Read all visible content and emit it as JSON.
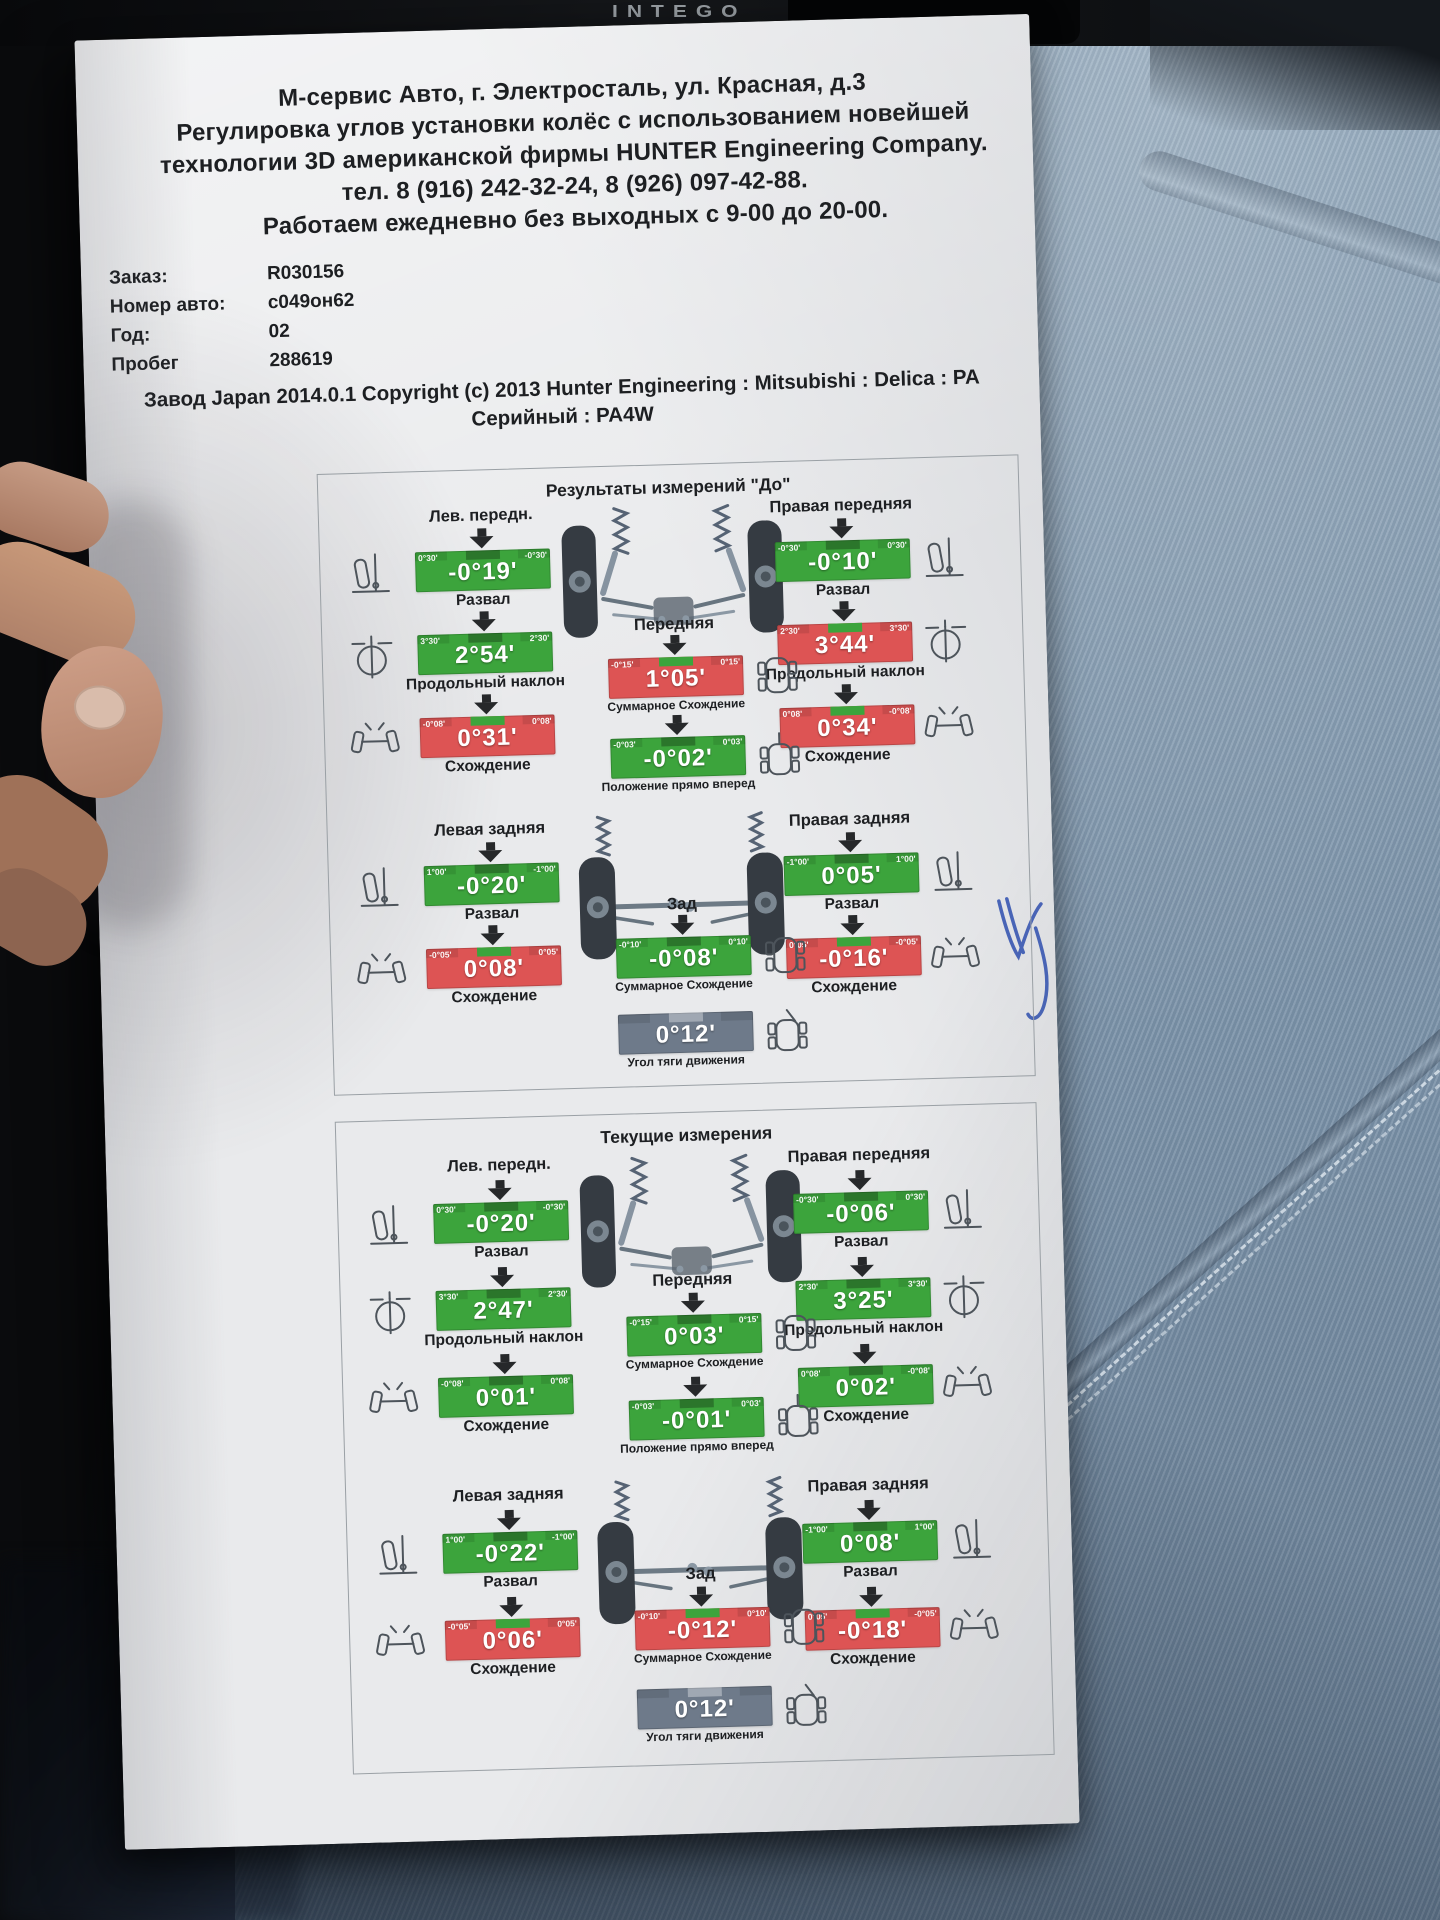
{
  "scene": {
    "dashboard_text": "INTEGO"
  },
  "header": {
    "lines": [
      "М-сервис Авто, г. Электросталь, ул. Красная, д.3",
      "Регулировка углов установки колёс с использованием новейшей",
      "технологии 3D американской фирмы HUNTER Engineering Company.",
      "тел. 8 (916) 242-32-24, 8 (926) 097-42-88.",
      "Работаем ежедневно без выходных с 9-00 до 20-00."
    ]
  },
  "info": {
    "rows": [
      {
        "label": "Заказ:",
        "value": "R030156"
      },
      {
        "label": "Номер авто:",
        "value": "с049он62"
      },
      {
        "label": "Год:",
        "value": "02"
      },
      {
        "label": "Пробег",
        "value": "288619"
      }
    ]
  },
  "factory": {
    "line1": "Завод Japan 2014.0.1 Copyright (c) 2013 Hunter Engineering : Mitsubishi : Delica : PA",
    "line2": "Серийный : PA4W"
  },
  "colors": {
    "green": "#3ca43c",
    "red": "#dd5454",
    "gray": "#6e7a8a"
  },
  "annotation": {
    "shape": "pen-checkmark",
    "color": "#2e4faf"
  },
  "panels": [
    {
      "title": "Результаты измерений \"До\"",
      "front": {
        "left_label": "Лев. передн.",
        "right_label": "Правая передняя",
        "axle_label": "Передняя",
        "left": [
          {
            "caption": "Развал",
            "value": "-0°19'",
            "status": "green",
            "range_left": "0°30'",
            "range_right": "-0°30'",
            "icon": "camber-icon"
          },
          {
            "caption": "Продольный наклон",
            "value": "2°54'",
            "status": "green",
            "range_left": "3°30'",
            "range_right": "2°30'",
            "icon": "caster-icon"
          },
          {
            "caption": "Схождение",
            "value": "0°31'",
            "status": "red",
            "range_left": "-0°08'",
            "range_right": "0°08'",
            "icon": "toe-icon"
          }
        ],
        "right": [
          {
            "caption": "Развал",
            "value": "-0°10'",
            "status": "green",
            "range_left": "-0°30'",
            "range_right": "0°30'",
            "icon": "camber-icon"
          },
          {
            "caption": "Продольный наклон",
            "value": "3°44'",
            "status": "red",
            "range_left": "2°30'",
            "range_right": "3°30'",
            "icon": "caster-icon"
          },
          {
            "caption": "Схождение",
            "value": "0°34'",
            "status": "red",
            "range_left": "0°08'",
            "range_right": "-0°08'",
            "icon": "toe-icon"
          }
        ],
        "center": [
          {
            "caption": "Суммарное Схождение",
            "value": "1°05'",
            "status": "red",
            "range_left": "-0°15'",
            "range_right": "0°15'",
            "icon": "total-toe-icon"
          },
          {
            "caption": "Положение прямо вперед",
            "value": "-0°02'",
            "status": "green",
            "range_left": "-0°03'",
            "range_right": "0°03'",
            "icon": "straight-ahead-icon"
          }
        ]
      },
      "rear": {
        "left_label": "Левая задняя",
        "right_label": "Правая задняя",
        "axle_label": "Зад",
        "left": [
          {
            "caption": "Развал",
            "value": "-0°20'",
            "status": "green",
            "range_left": "1°00'",
            "range_right": "-1°00'",
            "icon": "camber-icon"
          },
          {
            "caption": "Схождение",
            "value": "0°08'",
            "status": "red",
            "range_left": "-0°05'",
            "range_right": "0°05'",
            "icon": "toe-icon"
          }
        ],
        "right": [
          {
            "caption": "Развал",
            "value": "0°05'",
            "status": "green",
            "range_left": "-1°00'",
            "range_right": "1°00'",
            "icon": "camber-icon"
          },
          {
            "caption": "Схождение",
            "value": "-0°16'",
            "status": "red",
            "range_left": "0°05'",
            "range_right": "-0°05'",
            "icon": "toe-icon"
          }
        ],
        "center": [
          {
            "caption": "Суммарное Схождение",
            "value": "-0°08'",
            "status": "green",
            "range_left": "-0°10'",
            "range_right": "0°10'",
            "icon": "total-toe-icon"
          },
          {
            "caption": "Угол тяги движения",
            "value": "0°12'",
            "status": "gray",
            "range_left": "",
            "range_right": "",
            "icon": "thrust-icon"
          }
        ]
      }
    },
    {
      "title": "Текущие измерения",
      "front": {
        "left_label": "Лев. передн.",
        "right_label": "Правая передняя",
        "axle_label": "Передняя",
        "left": [
          {
            "caption": "Развал",
            "value": "-0°20'",
            "status": "green",
            "range_left": "0°30'",
            "range_right": "-0°30'",
            "icon": "camber-icon"
          },
          {
            "caption": "Продольный наклон",
            "value": "2°47'",
            "status": "green",
            "range_left": "3°30'",
            "range_right": "2°30'",
            "icon": "caster-icon"
          },
          {
            "caption": "Схождение",
            "value": "0°01'",
            "status": "green",
            "range_left": "-0°08'",
            "range_right": "0°08'",
            "icon": "toe-icon"
          }
        ],
        "right": [
          {
            "caption": "Развал",
            "value": "-0°06'",
            "status": "green",
            "range_left": "-0°30'",
            "range_right": "0°30'",
            "icon": "camber-icon"
          },
          {
            "caption": "Продольный наклон",
            "value": "3°25'",
            "status": "green",
            "range_left": "2°30'",
            "range_right": "3°30'",
            "icon": "caster-icon"
          },
          {
            "caption": "Схождение",
            "value": "0°02'",
            "status": "green",
            "range_left": "0°08'",
            "range_right": "-0°08'",
            "icon": "toe-icon"
          }
        ],
        "center": [
          {
            "caption": "Суммарное Схождение",
            "value": "0°03'",
            "status": "green",
            "range_left": "-0°15'",
            "range_right": "0°15'",
            "icon": "total-toe-icon"
          },
          {
            "caption": "Положение прямо вперед",
            "value": "-0°01'",
            "status": "green",
            "range_left": "-0°03'",
            "range_right": "0°03'",
            "icon": "straight-ahead-icon"
          }
        ]
      },
      "rear": {
        "left_label": "Левая задняя",
        "right_label": "Правая задняя",
        "axle_label": "Зад",
        "left": [
          {
            "caption": "Развал",
            "value": "-0°22'",
            "status": "green",
            "range_left": "1°00'",
            "range_right": "-1°00'",
            "icon": "camber-icon"
          },
          {
            "caption": "Схождение",
            "value": "0°06'",
            "status": "red",
            "range_left": "-0°05'",
            "range_right": "0°05'",
            "icon": "toe-icon"
          }
        ],
        "right": [
          {
            "caption": "Развал",
            "value": "0°08'",
            "status": "green",
            "range_left": "-1°00'",
            "range_right": "1°00'",
            "icon": "camber-icon"
          },
          {
            "caption": "Схождение",
            "value": "-0°18'",
            "status": "red",
            "range_left": "0°05'",
            "range_right": "-0°05'",
            "icon": "toe-icon"
          }
        ],
        "center": [
          {
            "caption": "Суммарное Схождение",
            "value": "-0°12'",
            "status": "red",
            "range_left": "-0°10'",
            "range_right": "0°10'",
            "icon": "total-toe-icon"
          },
          {
            "caption": "Угол тяги движения",
            "value": "0°12'",
            "status": "gray",
            "range_left": "",
            "range_right": "",
            "icon": "thrust-icon"
          }
        ]
      }
    }
  ]
}
